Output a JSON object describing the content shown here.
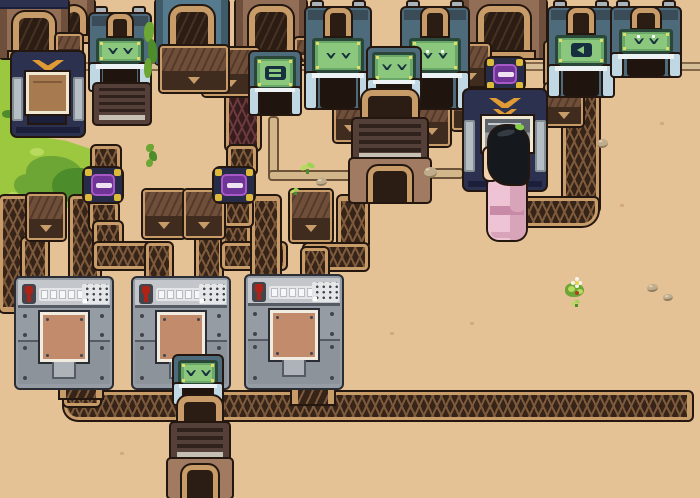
{
  "meta": {
    "description": "top-down pixel-art factory game scene: sorter machines, conveyor tubes, filter nodes, processors and a villager on desert sand"
  },
  "palette": {
    "sand": "#e5c295",
    "ledge": "#d6bf96",
    "ledgeline": "#84684a",
    "rail": "#c89c69",
    "outline": "#241710",
    "beltdark": "#362419",
    "chv": "#7d5a3c",
    "maroon": "#371c1e",
    "chvm": "#6b3a3c",
    "cratetop": "#6f4e3a",
    "cratefront": "#402c1e",
    "sorterbody": "#4e6b7b",
    "sorterband": "#3a4c58",
    "chimney": "#a9b3b9",
    "screenframe": "#2a4739",
    "screenbg": "#69a868",
    "screeninner": "#8cc77e",
    "glyph": "#16303f",
    "screendot": "#dfdc6a",
    "legs": "#bfd8e3",
    "legrail": "#edf3f5",
    "openingdark": "#1f150e",
    "dockblue": "#567a8e",
    "dockbluedark": "#3f5a68",
    "dockbrown": "#916e55",
    "dockbrowndark": "#6d4f3c",
    "archdark": "#2c1d14",
    "navy": "#2c3150",
    "navydark": "#1b1f3a",
    "wing": "#e09b35",
    "pylon": "#b5bec5",
    "pylondark": "#848d94",
    "wcrate": "#a87a50",
    "wframe": "#efe7d2",
    "wscreentop": "#5e646b",
    "wscreenbot": "#9aa0a6",
    "glow": "#ef9c2c",
    "glowlight": "#ffc050",
    "nodebody": "#262b47",
    "nodeyellow": "#ddba3a",
    "nodecore": "#6f3596",
    "nodeglow": "#a958c8",
    "nodeslit": "#efe3f2",
    "furnacetop": "#554039",
    "furnaceslat": "#2f211c",
    "furnacelight": "#c6bfb4",
    "furnacelow": "#a07a61",
    "graybody": "#969ca4",
    "graybody2": "#8d939b",
    "graypanel": "#c3c6ca",
    "graystrip": "#e4e6e8",
    "graybtn": "#f6f7f8",
    "grayseam": "#565b63",
    "graydot": "#42454c",
    "red": "#ae2317",
    "copper": "#c28b6c",
    "copperframe": "#f1ebe0",
    "pipefill": "#d3b78a",
    "pipeline": "#6b5238",
    "grass": "#9cc840",
    "grasslight": "#b7da5f",
    "grassdark": "#6da634",
    "grassdarker": "#4d8c2b",
    "hair": "#15191e",
    "hairhi": "#343b42",
    "sprig": "#85cf4a",
    "skin": "#f2d1b0",
    "eyec": "#30241d",
    "robe": "#eec3d3",
    "robesh": "#d8a4ba",
    "sash": "#c88aa6",
    "pebble": "#c0ab8a",
    "pebbledark": "#8f7d60",
    "speck": "#d2a87c",
    "crack": "#c19a6d",
    "flowerwhite": "#f6f3ec",
    "flowercenter": "#e8d44e",
    "berry": "#b04028"
  },
  "scene": {
    "width": 700,
    "height": 498,
    "entities": [
      {
        "t": "ledge",
        "n": "wall-ledge",
        "x": 0,
        "y": 62,
        "w": 700,
        "h": 9
      },
      {
        "t": "grass",
        "n": "grass-strip",
        "v": "strip",
        "x": 0,
        "y": 0,
        "w": 32,
        "h": 150
      },
      {
        "t": "grass",
        "n": "grass-patch",
        "v": "blob",
        "x": 0,
        "y": 134,
        "w": 120,
        "h": 84
      },
      {
        "t": "grass",
        "n": "grass-sliver",
        "v": "sliver",
        "x": 60,
        "y": 26,
        "w": 9,
        "h": 28
      },
      {
        "t": "grass",
        "n": "grass-sliver",
        "v": "sliver",
        "x": 76,
        "y": 0,
        "w": 15,
        "h": 20
      },
      {
        "t": "crack",
        "x": 543,
        "y": 72,
        "w": 14,
        "h": 46
      },
      {
        "t": "crack",
        "x": 229,
        "y": 98,
        "w": 16,
        "h": 42
      },
      {
        "t": "speck",
        "x": 356,
        "y": 250
      },
      {
        "t": "speck",
        "x": 470,
        "y": 322
      },
      {
        "t": "speck",
        "x": 120,
        "y": 452
      },
      {
        "t": "speck",
        "x": 620,
        "y": 204
      },
      {
        "t": "speck",
        "x": 660,
        "y": 122
      },
      {
        "t": "speck",
        "x": 390,
        "y": 332
      },
      {
        "t": "pipe",
        "x": 268,
        "y": 116,
        "w": 11,
        "h": 62
      },
      {
        "t": "pipe",
        "x": 268,
        "y": 170,
        "w": 92,
        "h": 11
      },
      {
        "t": "pipe",
        "x": 428,
        "y": 168,
        "w": 36,
        "h": 11
      },
      {
        "t": "pipe",
        "x": 16,
        "y": 230,
        "w": 10,
        "h": 38
      },
      {
        "t": "belt",
        "x": 0,
        "y": 196,
        "w": 34,
        "h": 116,
        "cap": "b"
      },
      {
        "t": "belt",
        "x": 70,
        "y": 196,
        "w": 30,
        "h": 88
      },
      {
        "t": "belt",
        "x": 22,
        "y": 238,
        "w": 26,
        "h": 48
      },
      {
        "t": "belt",
        "x": 92,
        "y": 146,
        "w": 28,
        "h": 28
      },
      {
        "t": "belt",
        "x": 90,
        "y": 202,
        "w": 28,
        "h": 28
      },
      {
        "t": "belt",
        "x": 94,
        "y": 222,
        "w": 28,
        "h": 30
      },
      {
        "t": "belt",
        "x": 94,
        "y": 243,
        "w": 58,
        "h": 26
      },
      {
        "t": "belt",
        "x": 146,
        "y": 243,
        "w": 26,
        "h": 42
      },
      {
        "t": "belt",
        "x": 196,
        "y": 232,
        "w": 26,
        "h": 52
      },
      {
        "t": "belt",
        "x": 222,
        "y": 222,
        "w": 28,
        "h": 28
      },
      {
        "t": "belt",
        "x": 222,
        "y": 243,
        "w": 64,
        "h": 26
      },
      {
        "t": "belt",
        "x": 252,
        "y": 196,
        "w": 28,
        "h": 92,
        "cap": "t"
      },
      {
        "t": "belt",
        "x": 338,
        "y": 196,
        "w": 30,
        "h": 52,
        "cap": "t"
      },
      {
        "t": "belt",
        "x": 226,
        "y": 86,
        "w": 34,
        "h": 64,
        "v": "m"
      },
      {
        "t": "belt",
        "x": 228,
        "y": 146,
        "w": 28,
        "h": 28
      },
      {
        "t": "belt",
        "x": 224,
        "y": 200,
        "w": 28,
        "h": 26
      },
      {
        "t": "belt",
        "x": 304,
        "y": 244,
        "w": 64,
        "h": 26
      },
      {
        "t": "belt",
        "x": 302,
        "y": 248,
        "w": 26,
        "h": 38
      },
      {
        "t": "belt",
        "x": 563,
        "y": 90,
        "w": 36,
        "h": 122
      },
      {
        "t": "belt",
        "x": 518,
        "y": 198,
        "w": 80,
        "h": 28,
        "corner": "br"
      },
      {
        "t": "belt",
        "x": 64,
        "y": 392,
        "w": 628,
        "h": 28,
        "cap": "r",
        "corner": "bl"
      },
      {
        "t": "belt",
        "x": 64,
        "y": 366,
        "w": 36,
        "h": 40
      },
      {
        "t": "chute",
        "n": "machine-output-chute",
        "x": 60,
        "y": 348,
        "w": 42,
        "h": 50
      },
      {
        "t": "chute",
        "n": "machine-output-chute",
        "x": 292,
        "y": 350,
        "w": 42,
        "h": 54
      },
      {
        "t": "dock",
        "v": "brown",
        "x": 54,
        "y": 0,
        "w": 40,
        "h": 42
      },
      {
        "t": "dock",
        "v": "brown",
        "band": true,
        "x": 0,
        "y": 0,
        "w": 68,
        "h": 58
      },
      {
        "t": "dock",
        "v": "blue",
        "x": 156,
        "y": 0,
        "w": 72,
        "h": 64
      },
      {
        "t": "dock",
        "v": "brown",
        "x": 236,
        "y": 0,
        "w": 70,
        "h": 62
      },
      {
        "t": "dock",
        "v": "brown",
        "x": 462,
        "y": 0,
        "w": 84,
        "h": 58
      },
      {
        "t": "crate",
        "x": 27,
        "y": 194,
        "w": 38,
        "h": 46
      },
      {
        "t": "crate",
        "x": 143,
        "y": 190,
        "w": 42,
        "h": 48
      },
      {
        "t": "crate",
        "x": 184,
        "y": 190,
        "w": 40,
        "h": 48
      },
      {
        "t": "crate",
        "x": 203,
        "y": 48,
        "w": 56,
        "h": 48
      },
      {
        "t": "crate",
        "x": 290,
        "y": 190,
        "w": 42,
        "h": 52
      },
      {
        "t": "crate",
        "x": 334,
        "y": 92,
        "w": 32,
        "h": 50
      },
      {
        "t": "crate",
        "x": 414,
        "y": 92,
        "w": 36,
        "h": 54
      },
      {
        "t": "crate",
        "x": 452,
        "y": 44,
        "w": 38,
        "h": 44
      },
      {
        "t": "crate",
        "x": 452,
        "y": 88,
        "w": 38,
        "h": 42
      },
      {
        "t": "crate",
        "x": 545,
        "y": 42,
        "w": 38,
        "h": 44
      },
      {
        "t": "crate",
        "x": 545,
        "y": 84,
        "w": 38,
        "h": 42
      },
      {
        "t": "crate",
        "x": 160,
        "y": 46,
        "w": 68,
        "h": 46
      },
      {
        "t": "crate",
        "x": 56,
        "y": 34,
        "w": 26,
        "h": 28
      },
      {
        "t": "crate",
        "x": 295,
        "y": 38,
        "w": 22,
        "h": 26
      },
      {
        "t": "node",
        "n": "filter-node",
        "x": 84,
        "y": 168,
        "w": 38,
        "h": 34
      },
      {
        "t": "node",
        "n": "filter-node",
        "x": 214,
        "y": 168,
        "w": 40,
        "h": 34
      },
      {
        "t": "sorter",
        "n": "sorter-machine",
        "x": 90,
        "y": 6,
        "w": 60,
        "h": 84,
        "g": "closed"
      },
      {
        "t": "sorter",
        "n": "sorter-machine",
        "x": 306,
        "y": 0,
        "w": 64,
        "h": 108,
        "g": "closed"
      },
      {
        "t": "sorter",
        "n": "sorter-machine",
        "x": 402,
        "y": 0,
        "w": 66,
        "h": 108,
        "g": "open"
      },
      {
        "t": "sorter",
        "n": "sorter-machine",
        "x": 549,
        "y": 0,
        "w": 64,
        "h": 96,
        "g": "arrow"
      },
      {
        "t": "sorter",
        "n": "sorter-machine",
        "x": 612,
        "y": 0,
        "w": 68,
        "h": 76,
        "g": "open"
      },
      {
        "t": "vent",
        "n": "vent-box",
        "x": 94,
        "y": 84,
        "w": 56,
        "h": 40
      },
      {
        "t": "mini",
        "n": "mini-sorter",
        "x": 250,
        "y": 52,
        "w": 50,
        "h": 62,
        "g": "eq"
      },
      {
        "t": "mini",
        "n": "mini-sorter",
        "x": 368,
        "y": 48,
        "w": 52,
        "h": 56,
        "g": "closed"
      },
      {
        "t": "furnace",
        "n": "processor",
        "x": 350,
        "y": 90,
        "w": 80,
        "h": 112
      },
      {
        "t": "navy",
        "n": "wing-machine",
        "v": "crate",
        "x": 12,
        "y": 52,
        "w": 72,
        "h": 84
      },
      {
        "t": "node",
        "n": "filter-node",
        "x": 486,
        "y": 58,
        "w": 38,
        "h": 32
      },
      {
        "t": "navy",
        "n": "wing-machine",
        "v": "screen",
        "x": 464,
        "y": 90,
        "w": 82,
        "h": 100
      },
      {
        "t": "gray",
        "n": "assembler",
        "x": 16,
        "y": 278,
        "w": 96,
        "h": 110
      },
      {
        "t": "gray",
        "n": "assembler",
        "x": 133,
        "y": 278,
        "w": 96,
        "h": 110
      },
      {
        "t": "gray",
        "n": "assembler",
        "x": 246,
        "y": 276,
        "w": 96,
        "h": 112
      },
      {
        "t": "mini",
        "n": "mini-sorter",
        "x": 174,
        "y": 356,
        "w": 48,
        "h": 48,
        "g": "closed"
      },
      {
        "t": "furnace",
        "n": "processor",
        "x": 168,
        "y": 396,
        "w": 64,
        "h": 102
      },
      {
        "t": "vine",
        "x": 144,
        "y": 22,
        "w": 14,
        "h": 58
      },
      {
        "t": "vine",
        "x": 146,
        "y": 144,
        "w": 12,
        "h": 24
      },
      {
        "t": "char",
        "n": "villager",
        "x": 484,
        "y": 126,
        "w": 46,
        "h": 120
      },
      {
        "t": "sprout",
        "x": 300,
        "y": 163
      },
      {
        "t": "sprout",
        "x": 290,
        "y": 188,
        "small": true
      },
      {
        "t": "flower",
        "x": 565,
        "y": 277
      },
      {
        "t": "sprout",
        "x": 571,
        "y": 300,
        "small": true
      },
      {
        "t": "pebble",
        "x": 316,
        "y": 178,
        "w": 11,
        "h": 8
      },
      {
        "t": "pebble",
        "x": 424,
        "y": 167,
        "w": 13,
        "h": 11
      },
      {
        "t": "pebble",
        "x": 597,
        "y": 139,
        "w": 11,
        "h": 9
      },
      {
        "t": "pebble",
        "x": 647,
        "y": 284,
        "w": 11,
        "h": 8
      },
      {
        "t": "pebble",
        "x": 663,
        "y": 294,
        "w": 10,
        "h": 7
      }
    ]
  }
}
